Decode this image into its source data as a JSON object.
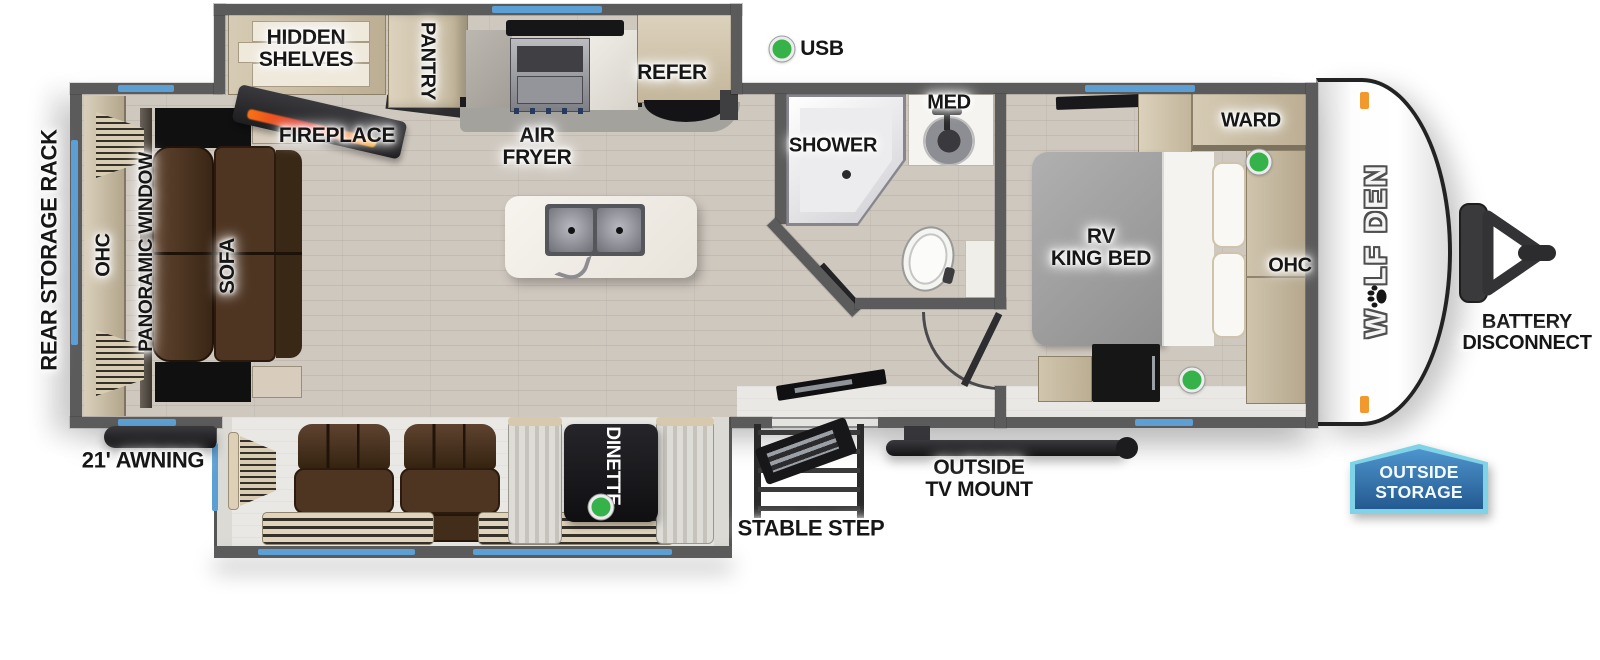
{
  "legend": {
    "usb": "USB"
  },
  "exterior": {
    "rear_storage_rack": "REAR STORAGE RACK",
    "awning": "21' AWNING",
    "stable_step": "STABLE STEP",
    "outside_tv_mount": [
      "OUTSIDE",
      "TV MOUNT"
    ],
    "battery_disconnect": [
      "BATTERY",
      "DISCONNECT"
    ]
  },
  "badge": {
    "line1": "OUTSIDE",
    "line2": "STORAGE"
  },
  "brand": {
    "first": "W",
    "rest": "LF DEN"
  },
  "living": {
    "ohc": "OHC",
    "panoramic_window": "PANORAMIC WINDOW",
    "sofa": "SOFA",
    "fireplace": "FIREPLACE",
    "hidden_shelves": [
      "HIDDEN",
      "SHELVES"
    ],
    "dinette": "DINETTE"
  },
  "kitchen": {
    "pantry": "PANTRY",
    "air_fryer": [
      "AIR",
      "FRYER"
    ],
    "refer": "REFER"
  },
  "bath": {
    "shower": "SHOWER",
    "med": "MED"
  },
  "bedroom": {
    "ward": "WARD",
    "bed": [
      "RV",
      "KING BED"
    ],
    "ohc": "OHC"
  },
  "colors": {
    "accent_blue": "#5b9fd4",
    "usb_green": "#35b34a",
    "wall_gray": "#5b5b5b",
    "badge_light": "#7ed3e6",
    "badge_dark": "#235a90",
    "flame_orange": "#f97316",
    "wood_tan": "#c9bda6"
  }
}
